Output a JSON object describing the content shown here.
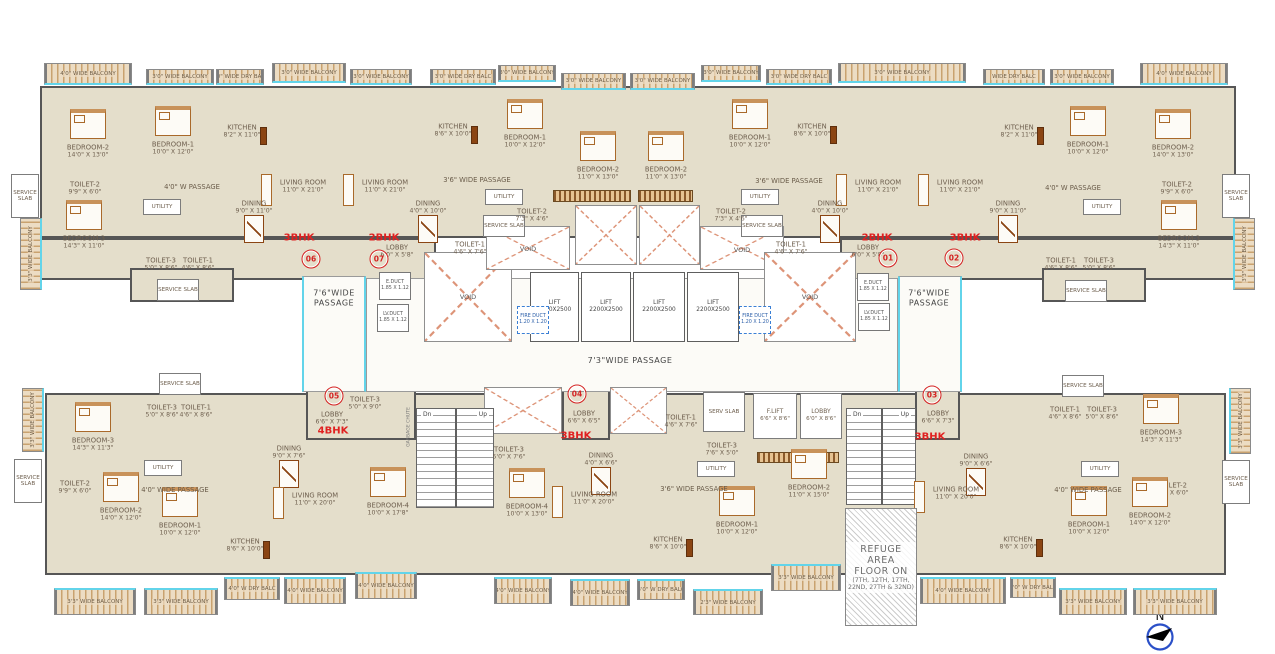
{
  "meta": {
    "drawing_type": "typical floor plan"
  },
  "colors": {
    "floor": "#e4decb",
    "wall": "#565656",
    "balcony_hatch": "#c9a26f",
    "window_cyan": "#62d4ea",
    "accent_red": "#e02020",
    "label_brown": "#6e5f4e"
  },
  "north": {
    "label": "N"
  },
  "plates": [
    [
      40,
      86,
      1196,
      152
    ],
    [
      40,
      238,
      396,
      42
    ],
    [
      840,
      238,
      396,
      42
    ],
    [
      130,
      268,
      104,
      34
    ],
    [
      1042,
      268,
      104,
      34
    ],
    [
      45,
      393,
      1181,
      182
    ],
    [
      562,
      387,
      48,
      53
    ],
    [
      915,
      387,
      45,
      53
    ],
    [
      306,
      387,
      110,
      53
    ]
  ],
  "corridors": [
    {
      "x": 302,
      "y": 276,
      "w": 64,
      "h": 116,
      "v": true
    },
    {
      "x": 898,
      "y": 276,
      "w": 64,
      "h": 116,
      "v": true
    },
    {
      "x": 366,
      "y": 278,
      "w": 532,
      "h": 114,
      "v": false
    }
  ],
  "boxes": [],
  "rooms": [
    [
      "BEDROOM-2",
      "14'0\" X 13'0\"",
      88,
      151,
      "b"
    ],
    [
      "BEDROOM-1",
      "10'0\" X 12'0\"",
      173,
      148,
      "b"
    ],
    [
      "KITCHEN",
      "8'2\" X 11'0\"",
      242,
      131,
      "k"
    ],
    [
      "LIVING ROOM",
      "11'0\" X 21'0\"",
      303,
      186,
      "l"
    ],
    [
      "DINING",
      "9'0\" X 11'0\"",
      254,
      207,
      "d"
    ],
    [
      "TOILET-2",
      "9'9\" X 6'0\"",
      85,
      188,
      "t"
    ],
    [
      "BEDROOM-3",
      "14'3\" X 11'0\"",
      84,
      242,
      "b"
    ],
    [
      "TOILET-3",
      "5'0\" X 8'6\"",
      161,
      264,
      "t"
    ],
    [
      "TOILET-1",
      "4'6\" X 8'6\"",
      198,
      264,
      "t"
    ],
    [
      "UTILITY",
      "",
      162,
      207,
      "u"
    ],
    [
      "SERVICE SLAB",
      "",
      25,
      196,
      "s",
      28,
      44
    ],
    [
      "SERVICE SLAB",
      "",
      178,
      290,
      "s"
    ],
    [
      "LIVING ROOM",
      "11'0\" X 21'0\"",
      385,
      186,
      "l"
    ],
    [
      "KITCHEN",
      "8'6\" X 10'0\"",
      453,
      130,
      "k"
    ],
    [
      "BEDROOM-1",
      "10'0\" X 12'0\"",
      525,
      141,
      "b"
    ],
    [
      "BEDROOM-2",
      "11'0\" X 13'0\"",
      598,
      173,
      "b"
    ],
    [
      "DINING",
      "4'0\" X 10'0\"",
      428,
      207,
      "d"
    ],
    [
      "UTILITY",
      "",
      504,
      197,
      "u"
    ],
    [
      "SERVICE SLAB",
      "",
      504,
      226,
      "s"
    ],
    [
      "TOILET-2",
      "7'3\" X 4'6\"",
      532,
      215,
      "t"
    ],
    [
      "TOILET-1",
      "4'6\" X 7'6\"",
      470,
      248,
      "t"
    ],
    [
      "BEDROOM-2",
      "11'0\" X 13'0\"",
      666,
      173,
      "b"
    ],
    [
      "BEDROOM-1",
      "10'0\" X 12'0\"",
      750,
      141,
      "b"
    ],
    [
      "KITCHEN",
      "8'6\" X 10'0\"",
      812,
      130,
      "k"
    ],
    [
      "LIVING ROOM",
      "11'0\" X 21'0\"",
      878,
      186,
      "l"
    ],
    [
      "DINING",
      "4'0\" X 10'0\"",
      830,
      207,
      "d"
    ],
    [
      "UTILITY",
      "",
      760,
      197,
      "u"
    ],
    [
      "SERVICE SLAB",
      "",
      762,
      226,
      "s"
    ],
    [
      "TOILET-2",
      "7'3\" X 4'6\"",
      731,
      215,
      "t"
    ],
    [
      "TOILET-1",
      "4'6\" X 7'6\"",
      791,
      248,
      "t"
    ],
    [
      "KITCHEN",
      "8'2\" X 11'0\"",
      1019,
      131,
      "k"
    ],
    [
      "BEDROOM-1",
      "10'0\" X 12'0\"",
      1088,
      148,
      "b"
    ],
    [
      "BEDROOM-2",
      "14'0\" X 13'0\"",
      1173,
      151,
      "b"
    ],
    [
      "LIVING ROOM",
      "11'0\" X 21'0\"",
      960,
      186,
      "l"
    ],
    [
      "DINING",
      "9'0\" X 11'0\"",
      1008,
      207,
      "d"
    ],
    [
      "TOILET-2",
      "9'9\" X 6'0\"",
      1177,
      188,
      "t"
    ],
    [
      "BEDROOM-3",
      "14'3\" X 11'0\"",
      1179,
      242,
      "b"
    ],
    [
      "TOILET-1",
      "4'6\" X 8'6\"",
      1061,
      264,
      "t"
    ],
    [
      "TOILET-3",
      "5'0\" X 8'6\"",
      1099,
      264,
      "t"
    ],
    [
      "UTILITY",
      "",
      1102,
      207,
      "u"
    ],
    [
      "SERVICE SLAB",
      "",
      1236,
      196,
      "s",
      28,
      44
    ],
    [
      "SERVICE SLAB",
      "",
      1086,
      291,
      "s"
    ],
    [
      "BEDROOM-3",
      "14'3\" X 11'3\"",
      93,
      444,
      "b"
    ],
    [
      "TOILET-3",
      "5'0\" X 8'6\"",
      162,
      411,
      "t"
    ],
    [
      "TOILET-1",
      "4'6\" X 8'6\"",
      196,
      411,
      "t"
    ],
    [
      "SERVICE SLAB",
      "",
      180,
      384,
      "s"
    ],
    [
      "SERVICE SLAB",
      "",
      28,
      481,
      "s",
      28,
      44
    ],
    [
      "TOILET-2",
      "9'9\" X 6'0\"",
      75,
      487,
      "t"
    ],
    [
      "UTILITY",
      "",
      163,
      468,
      "u"
    ],
    [
      "DINING",
      "9'0\" X 7'6\"",
      289,
      452,
      "d"
    ],
    [
      "BEDROOM-2",
      "14'0\" X 12'0\"",
      121,
      514,
      "b"
    ],
    [
      "BEDROOM-1",
      "10'0\" X 12'0\"",
      180,
      529,
      "b"
    ],
    [
      "KITCHEN",
      "8'6\" X 10'0\"",
      245,
      545,
      "k"
    ],
    [
      "LIVING ROOM",
      "11'0\" X 20'0\"",
      315,
      499,
      "l"
    ],
    [
      "BEDROOM-4",
      "10'0\" X 17'8\"",
      388,
      509,
      "b"
    ],
    [
      "TOILET-3",
      "5'0\" X 9'0\"",
      365,
      403,
      "t"
    ],
    [
      "TOILET-3",
      "5'0\" X 7'6\"",
      509,
      453,
      "t"
    ],
    [
      "BEDROOM-4",
      "10'0\" X 13'0\"",
      527,
      510,
      "b"
    ],
    [
      "DINING",
      "4'0\" X 6'6\"",
      601,
      459,
      "d"
    ],
    [
      "LIVING ROOM",
      "11'0\" X 20'0\"",
      594,
      498,
      "l"
    ],
    [
      "KITCHEN",
      "8'6\" X 10'0\"",
      668,
      543,
      "k"
    ],
    [
      "TOILET-1",
      "4'6\" X 7'6\"",
      681,
      421,
      "t"
    ],
    [
      "TOILET-3",
      "7'6\" X 5'0\"",
      722,
      449,
      "t"
    ],
    [
      "SERV SLAB",
      "",
      724,
      412,
      "s",
      42,
      40
    ],
    [
      "UTILITY",
      "",
      716,
      469,
      "u"
    ],
    [
      "BEDROOM-1",
      "10'0\" X 12'0\"",
      737,
      528,
      "b"
    ],
    [
      "BEDROOM-2",
      "11'0\" X 15'0\"",
      809,
      491,
      "b"
    ],
    [
      "F.LIFT",
      "6'6\" X 8'6\"",
      775,
      416,
      "c",
      44,
      46
    ],
    [
      "LOBBY",
      "6'0\" X 8'6\"",
      821,
      416,
      "c",
      42,
      46
    ],
    [
      "DINING",
      "9'0\" X 6'6\"",
      976,
      460,
      "d"
    ],
    [
      "LIVING ROOM",
      "11'0\" X 20'0\"",
      956,
      493,
      "l"
    ],
    [
      "KITCHEN",
      "8'6\" X 10'0\"",
      1018,
      543,
      "k"
    ],
    [
      "TOILET-1",
      "4'6\" X 8'6\"",
      1065,
      413,
      "t"
    ],
    [
      "TOILET-3",
      "5'0\" X 8'6\"",
      1102,
      413,
      "t"
    ],
    [
      "SERVICE SLAB",
      "",
      1083,
      386,
      "s"
    ],
    [
      "UTILITY",
      "",
      1100,
      469,
      "u"
    ],
    [
      "BEDROOM-3",
      "14'3\" X 11'3\"",
      1161,
      436,
      "b"
    ],
    [
      "TOILET-2",
      "9'9\" X 6'0\"",
      1172,
      489,
      "t"
    ],
    [
      "SERVICE SLAB",
      "",
      1236,
      482,
      "s",
      28,
      44
    ],
    [
      "BEDROOM-2",
      "14'0\" X 12'0\"",
      1150,
      519,
      "b"
    ],
    [
      "BEDROOM-1",
      "10'0\" X 12'0\"",
      1089,
      528,
      "b"
    ],
    [
      "LOBBY",
      "6'0\" X 5'8\"",
      397,
      251,
      "p"
    ],
    [
      "LOBBY",
      "6'0\" X 5'8\"",
      868,
      251,
      "p"
    ],
    [
      "LOBBY",
      "6'6\" X 7'3\"",
      332,
      418,
      "p"
    ],
    [
      "LOBBY",
      "6'6\" X 6'5\"",
      584,
      417,
      "p"
    ],
    [
      "LOBBY",
      "6'6\" X 7'3\"",
      938,
      417,
      "p"
    ]
  ],
  "passages": [
    [
      "4'0\" W PASSAGE",
      192,
      187,
      0
    ],
    [
      "3'6\" WIDE PASSAGE",
      477,
      180,
      0
    ],
    [
      "3'6\" WIDE PASSAGE",
      789,
      181,
      0
    ],
    [
      "4'0\" W PASSAGE",
      1073,
      188,
      0
    ],
    [
      "4'0\" WIDE PASSAGE",
      175,
      490,
      0
    ],
    [
      "3'6\" WIDE PASSAGE",
      694,
      489,
      0
    ],
    [
      "4'0\" WIDE PASSAGE",
      1088,
      490,
      0
    ],
    [
      "7'3\"WIDE  PASSAGE",
      630,
      361,
      2
    ],
    [
      "7'6\"WIDE|PASSAGE",
      334,
      298,
      2
    ],
    [
      "7'6\"WIDE|PASSAGE",
      929,
      298,
      2
    ],
    [
      "GARBAGE CHUTE",
      409,
      427,
      1
    ]
  ],
  "balconies": [
    [
      "4'0\" WIDE BALCONY",
      44,
      63,
      88,
      22,
      "t"
    ],
    [
      "3'0\" WIDE BALCONY",
      146,
      69,
      68,
      16,
      "t"
    ],
    [
      "3'0\" WIDE DRY BALC",
      216,
      69,
      48,
      16,
      "t"
    ],
    [
      "3'0\" WIDE BALCONY",
      272,
      63,
      74,
      20,
      "t"
    ],
    [
      "3'0\" WIDE BALCONY",
      350,
      69,
      62,
      16,
      "t"
    ],
    [
      "3'0\" WIDE DRY BALC",
      430,
      69,
      66,
      16,
      "t"
    ],
    [
      "3'0\" WIDE BALCONY",
      498,
      65,
      58,
      17,
      "t"
    ],
    [
      "3'0\" WIDE BALCONY",
      561,
      73,
      65,
      17,
      "t"
    ],
    [
      "3'0\" WIDE BALCONY",
      630,
      73,
      65,
      17,
      "t"
    ],
    [
      "3'0\" WIDE BALCONY",
      701,
      65,
      60,
      17,
      "t"
    ],
    [
      "3'0\" WIDE DRY BALC",
      766,
      69,
      66,
      16,
      "t"
    ],
    [
      "3'0\" WIDE BALCONY",
      838,
      63,
      128,
      20,
      "t"
    ],
    [
      "WIDE DRY BALC",
      983,
      69,
      62,
      16,
      "t"
    ],
    [
      "3'0\" WIDE BALCONY",
      1050,
      69,
      64,
      16,
      "t"
    ],
    [
      "4'0\" WIDE BALCONY",
      1140,
      63,
      88,
      22,
      "t"
    ],
    [
      "3'3\" WIDE BALCONY",
      20,
      218,
      22,
      72,
      "l"
    ],
    [
      "3'3\" WIDE BALCONY",
      1233,
      218,
      22,
      72,
      "r"
    ],
    [
      "3'3\" WIDE BALCONY",
      22,
      388,
      22,
      64,
      "l"
    ],
    [
      "3'3\" WIDE BALCONY",
      1229,
      388,
      22,
      66,
      "r"
    ],
    [
      "3'3\" WIDE BALCONY",
      54,
      588,
      82,
      27,
      "b"
    ],
    [
      "3'3\" WIDE BALCONY",
      144,
      588,
      74,
      27,
      "b"
    ],
    [
      "4'0\" W DRY BALC",
      224,
      577,
      56,
      23,
      "b"
    ],
    [
      "4'0\" WIDE BALCONY",
      284,
      577,
      62,
      27,
      "b"
    ],
    [
      "4'0\" WIDE BALCONY",
      355,
      572,
      62,
      27,
      "b"
    ],
    [
      "4'0\" WIDE BALCONY",
      494,
      577,
      58,
      27,
      "b"
    ],
    [
      "4'0\" WIDE BALCONY",
      570,
      579,
      60,
      27,
      "b"
    ],
    [
      "3'0\" W DRY BALC",
      637,
      579,
      48,
      21,
      "b"
    ],
    [
      "2'3\" WIDE BALCONY",
      693,
      589,
      70,
      26,
      "b"
    ],
    [
      "3'3\" WIDE BALCONY",
      771,
      564,
      70,
      27,
      "b"
    ],
    [
      "4'0\" WIDE BALCONY",
      920,
      577,
      86,
      27,
      "b"
    ],
    [
      "4'0\" W DRY BALC",
      1010,
      577,
      46,
      21,
      "b"
    ],
    [
      "3'3\" WIDE BALCONY",
      1059,
      588,
      68,
      27,
      "b"
    ],
    [
      "3'3\" WIDE BALCONY",
      1133,
      588,
      84,
      27,
      "b"
    ]
  ],
  "voids": [
    [
      424,
      252,
      88,
      90,
      "VOID",
      467,
      296
    ],
    [
      486,
      226,
      84,
      44,
      "VOID",
      514,
      248
    ],
    [
      575,
      205,
      62,
      60,
      null,
      0,
      0
    ],
    [
      639,
      205,
      61,
      60,
      null,
      0,
      0
    ],
    [
      700,
      226,
      84,
      44,
      "VOID",
      722,
      249
    ],
    [
      764,
      252,
      92,
      90,
      "VOID",
      810,
      296
    ],
    [
      484,
      387,
      78,
      47,
      null,
      0,
      0
    ],
    [
      610,
      387,
      57,
      47,
      null,
      0,
      0
    ]
  ],
  "lifts": {
    "label": "LIFT",
    "size": "2200X2500",
    "shafts": [
      [
        530,
        272,
        49,
        70
      ],
      [
        581,
        272,
        50,
        70
      ],
      [
        633,
        272,
        52,
        70
      ],
      [
        687,
        272,
        52,
        70
      ]
    ]
  },
  "stairs": [
    {
      "x": 416,
      "y": 408,
      "w": 78,
      "h": 100,
      "dn": "Dn",
      "up": "Up"
    },
    {
      "x": 846,
      "y": 408,
      "w": 70,
      "h": 97,
      "dn": "Dn",
      "up": "Up"
    }
  ],
  "ducts": [
    [
      "E.DUCT",
      "1.85 X 1.12",
      395,
      286,
      false
    ],
    [
      "LV.DUCT",
      "1.85 X 1.12",
      393,
      318,
      false
    ],
    [
      "E.DUCT",
      "1.85 X 1.12",
      873,
      287,
      false
    ],
    [
      "LV.DUCT",
      "1.85 X 1.12",
      874,
      317,
      false
    ],
    [
      "FIRE DUCT",
      "1.20 X 1.20",
      533,
      320,
      true
    ],
    [
      "FIRE DUCT",
      "1.20 X 1.20",
      755,
      320,
      true
    ]
  ],
  "wardrobes": [
    [
      553,
      190,
      78,
      12
    ],
    [
      638,
      190,
      55,
      12
    ],
    [
      757,
      452,
      82,
      11
    ]
  ],
  "units": [
    {
      "no": "06",
      "bhk": "3BHK",
      "cx": 311,
      "cy": 259,
      "bx": 299,
      "by": 238
    },
    {
      "no": "07",
      "bhk": "2BHK",
      "cx": 379,
      "cy": 259,
      "bx": 384,
      "by": 238
    },
    {
      "no": "01",
      "bhk": "2BHK",
      "cx": 888,
      "cy": 258,
      "bx": 877,
      "by": 238
    },
    {
      "no": "02",
      "bhk": "3BHK",
      "cx": 954,
      "cy": 258,
      "bx": 965,
      "by": 238
    },
    {
      "no": "05",
      "bhk": "4BHK",
      "cx": 334,
      "cy": 396,
      "bx": 333,
      "by": 431
    },
    {
      "no": "04",
      "bhk": "3BHK",
      "cx": 577,
      "cy": 394,
      "bx": 576,
      "by": 436
    },
    {
      "no": "03",
      "bhk": "3BHK",
      "cx": 932,
      "cy": 395,
      "bx": 930,
      "by": 437
    }
  ],
  "refuge": {
    "x": 845,
    "y": 508,
    "w": 72,
    "h": 118,
    "lines": [
      "REFUGE AREA",
      "FLOOR ON",
      "(7TH, 12TH, 17TH,",
      "22ND, 27TH & 32ND)"
    ]
  }
}
